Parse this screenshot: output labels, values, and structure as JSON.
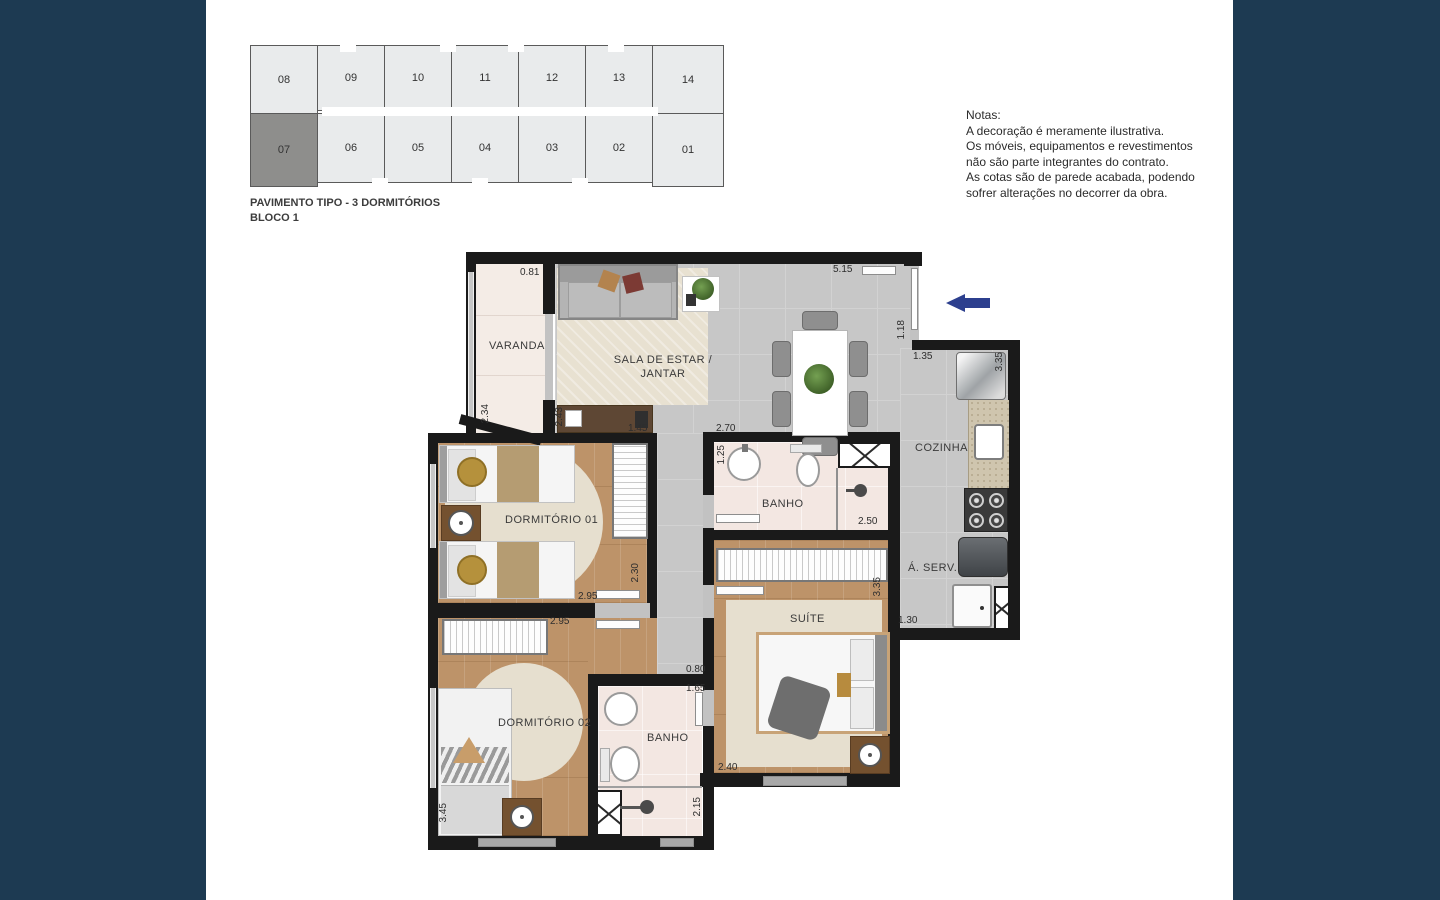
{
  "colors": {
    "sidebar": "#1d3a52",
    "arrow": "#2c3f8e",
    "keyplan_unit_fill": "#e9ebec",
    "keyplan_highlight_fill": "#8e8e8c",
    "wall": "#1a1a1a"
  },
  "keyplan": {
    "units_top": [
      "08",
      "09",
      "10",
      "11",
      "12",
      "13",
      "14"
    ],
    "units_bottom": [
      "07",
      "06",
      "05",
      "04",
      "03",
      "02",
      "01"
    ],
    "highlighted_unit": "07",
    "caption_line1": "PAVIMENTO TIPO - 3 DORMITÓRIOS",
    "caption_line2": "BLOCO 1"
  },
  "notes": {
    "title": "Notas:",
    "lines": [
      "A decoração é meramente ilustrativa.",
      "Os móveis, equipamentos e revestimentos",
      "não são parte integrantes do contrato.",
      "As cotas são de parede acabada, podendo",
      "sofrer alterações no decorrer da obra."
    ]
  },
  "plan": {
    "rooms": {
      "varanda": "VARANDA",
      "sala_l1": "SALA DE ESTAR /",
      "sala_l2": "JANTAR",
      "dorm1": "DORMITÓRIO 01",
      "banho1": "BANHO",
      "cozinha": "COZINHA",
      "aserv": "Á. SERV.",
      "suite": "SUÍTE",
      "dorm2": "DORMITÓRIO 02",
      "banho2": "BANHO"
    },
    "dims": {
      "varanda_top": "0.81",
      "sala_top": "5.15",
      "entry": "1.18",
      "cozinha_top": "1.35",
      "cozinha_right": "3.35",
      "varanda_left": "2.34",
      "desk_left": "2.43",
      "desk_bottom": "1.45",
      "banho1_top": "2.70",
      "banho1_left": "1.25",
      "banho1_right": "2.50",
      "dorm1_right": "2.30",
      "dorm1_bottom": "2.95",
      "dorm2_top": "2.95",
      "hall_top": "0.80",
      "banho2_top": "1.65",
      "suite_right": "3.35",
      "aserv_bottom": "1.30",
      "suite_bottom": "2.40",
      "banho2_right": "2.15",
      "dorm2_left": "3.45"
    }
  }
}
